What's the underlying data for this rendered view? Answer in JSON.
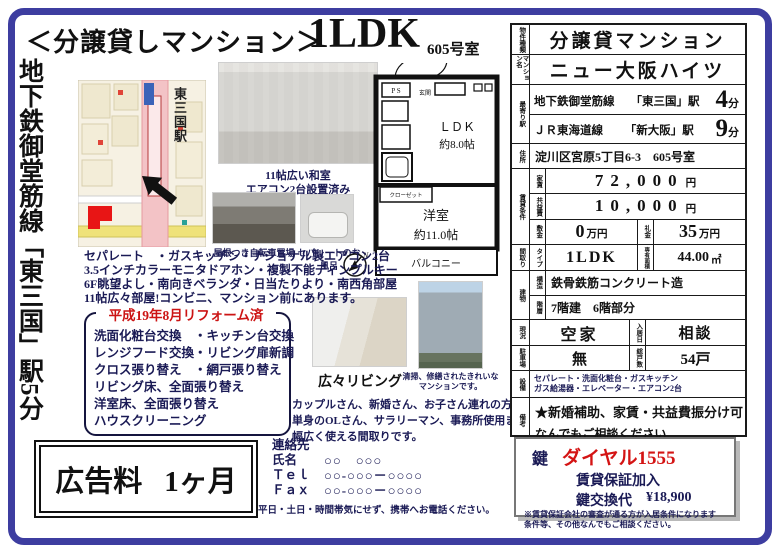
{
  "header": {
    "title_prefix": "＜分譲貸しマンション＞",
    "title_type": "1LDK",
    "room_no": "605号室"
  },
  "left_banner": "地下鉄御堂筋線「東三国」駅5分",
  "map": {
    "station_label": "東三国駅"
  },
  "photos": {
    "washitsu_caption1": "11帖広い和室",
    "washitsu_caption2": "エアコン2台設置済み",
    "bicycle_caption": "屋根つき自転車置場",
    "bath_caption": "セパレートのお風呂",
    "living_caption": "広々リビング",
    "building_caption1": "清掃、修繕されたきれいな",
    "building_caption2": "マンションです。"
  },
  "floorplan": {
    "ps": "P S",
    "entrance": "玄関",
    "ldk": "ＬＤＫ",
    "ldk_size": "約8.0帖",
    "closet": "クローゼット",
    "room": "洋室",
    "room_size": "約11.0帖",
    "balcony": "バルコニー",
    "compass": "N"
  },
  "features": {
    "line1": "セパレート　・ガスキッチン・ナショナル製エアコン2台",
    "line2": "3.5インチカラーモニタドアホン・複製不能ディンプルキー",
    "line3": "6F眺望よし・南向きベランダ・日当たりより・南西角部屋",
    "line4": "11帖広々部屋!コンビニ、マンション前にあります。"
  },
  "reform": {
    "title": "平成19年8月リフォーム済",
    "item1": "洗面化粧台交換　・キッチン台交換",
    "item2": "レンジフード交換・リビング扉新調",
    "item3": "クロス張り替え　・網戸張り替え",
    "item4": "リビング床、全面張り替え",
    "item5": "洋室床、全面張り替え",
    "item6": "ハウスクリーニング"
  },
  "audience": {
    "line1": "カップルさん、新婚さん、お子さん連れの方から、",
    "line2": "単身のOLさん、サラリーマン、事務所使用まで",
    "line3": "幅広く使える間取りです。"
  },
  "table": {
    "property_type_label": "物件種類",
    "property_type": "分譲貸マンション",
    "building_name_label": "マンション名",
    "building_name": "ニュー大阪ハイツ",
    "station_label": "最寄り駅",
    "station1_line": "地下鉄御堂筋線",
    "station1_name": "「東三国」駅",
    "station1_min": "4",
    "station2_line": "ＪＲ東海道線",
    "station2_name": "「新大阪」駅",
    "station2_min": "9",
    "min_suffix": "分",
    "address_label": "住所",
    "address": "淀川区宮原5丁目6-3　605号室",
    "terms_label": "賃貸条件",
    "rent_label": "家賃",
    "rent": "72,000",
    "yen": "円",
    "fee_label": "共益費",
    "fee": "10,000",
    "deposit_label": "敷金",
    "deposit": "0",
    "man_yen": "万円",
    "key_money_label": "礼金",
    "key_money": "35",
    "layout_label": "間取り",
    "type_label": "タイプ",
    "type": "1LDK",
    "area_label": "専有面積",
    "area": "44.00",
    "sqm": "㎡",
    "building_label": "建物",
    "structure_label": "構造",
    "structure": "鉄骨鉄筋コンクリート造",
    "floors_label": "階層",
    "floors": "7階建　6階部分",
    "status_label": "現況",
    "status": "空家",
    "movein_label": "入居日",
    "movein": "相談",
    "parking_label": "駐車場",
    "parking": "無",
    "units_label": "総戸数",
    "units": "54戸",
    "equipment_label": "設備",
    "equipment1": "セパレート・洗面化粧台・ガスキッチン",
    "equipment2": "ガス給湯器・エレベーター・エアコン2台",
    "remarks_label": "備考",
    "remarks1": "★新婚補助、家賃・共益費振分け可",
    "remarks2": "なんでもご相談ください"
  },
  "ad_fee": {
    "label": "広告料",
    "value": "1ヶ月"
  },
  "contact": {
    "heading": "連絡先",
    "name_label": "氏名",
    "name_value": "○○　○○○",
    "tel_label": "Ｔｅｌ",
    "tel_value": "○○-○○○－○○○○",
    "fax_label": "Ｆａｘ",
    "fax_value": "○○-○○○－○○○○",
    "footer_note": "平日・土日・時間帯気にせず、携帯へお電話ください。"
  },
  "key_box": {
    "key_label": "鍵",
    "dial": "ダイヤル1555",
    "guarantee": "賃貸保証加入",
    "exchange_label": "鍵交換代",
    "exchange_value": "¥18,900",
    "note1": "※賃貸保証会社の審査が通る方が入居条件になります",
    "note2": "条件等、その他なんでもご相談ください。"
  }
}
